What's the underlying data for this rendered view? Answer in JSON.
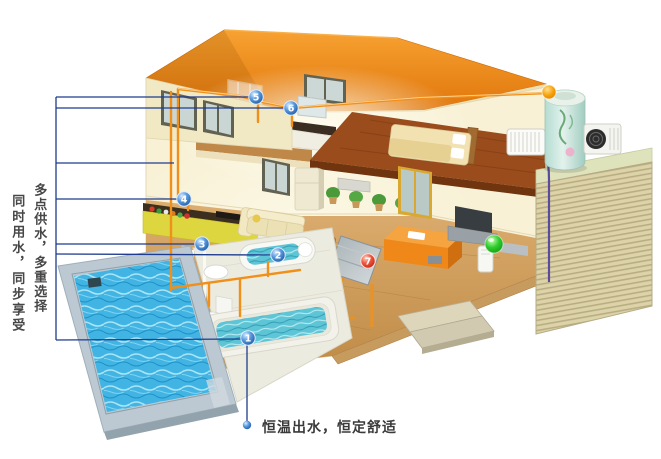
{
  "captions": {
    "left_primary": "多点供水，多重选择",
    "left_secondary": "同时用水，同步享受",
    "bottom": "恒温出水，恒定舒适"
  },
  "markers": {
    "m1": {
      "label": "1"
    },
    "m2": {
      "label": "2"
    },
    "m3": {
      "label": "3"
    },
    "m4": {
      "label": "4"
    },
    "m5": {
      "label": "5"
    },
    "m6": {
      "label": "6"
    },
    "m7": {
      "label": "7"
    }
  },
  "colors": {
    "roof_orange": "#ef8a16",
    "pipe_orange": "#f0901a",
    "callout_navy": "#1e3c8e",
    "marker_blue": "#2a66b8",
    "marker_red": "#d93a20",
    "indicator_green": "#24c326",
    "indicator_orange": "#f0a000",
    "pool_water": "#41b4e4",
    "caption_text": "#474747"
  }
}
